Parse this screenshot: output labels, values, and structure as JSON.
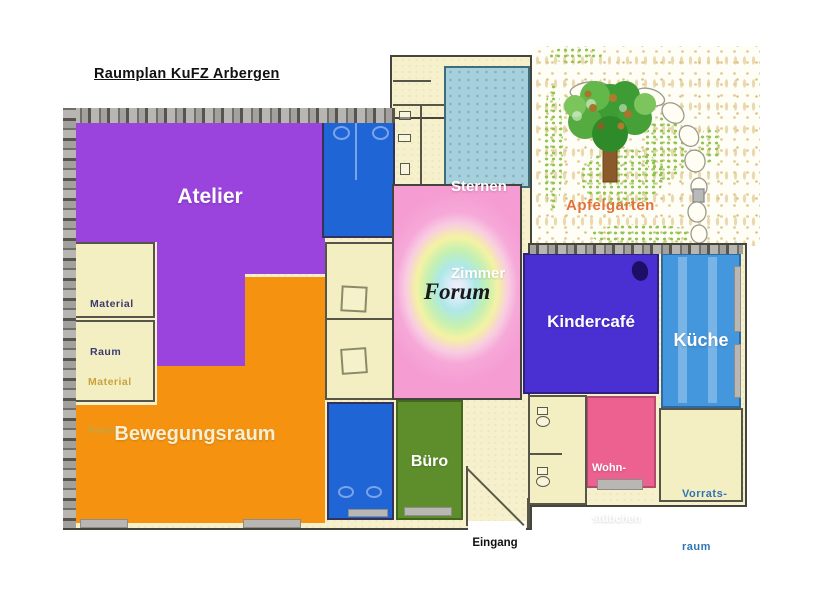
{
  "title": "Raumplan KuFZ Arbergen",
  "entrance": {
    "label": "Eingang"
  },
  "rooms": {
    "atelier": {
      "label": "Atelier"
    },
    "material_raum_1": {
      "line1": "Material",
      "line2": "Raum"
    },
    "material_raum_2": {
      "line1": "Material",
      "line2": "Raum"
    },
    "bewegungsraum": {
      "label": "Bewegungsraum"
    },
    "sternenzimmer": {
      "line1": "Sternen",
      "line2": "Zimmer"
    },
    "forum": {
      "label": "Forum"
    },
    "apfelgarten": {
      "label": "Apfelgarten"
    },
    "kindercafe": {
      "label": "Kindercafé"
    },
    "kueche": {
      "label": "Küche"
    },
    "buero": {
      "label": "Büro"
    },
    "wohnstuebchen": {
      "line1": "Wohn-",
      "line2": "stübchen"
    },
    "vorratsraum": {
      "line1": "Vorrats-",
      "line2": "raum"
    }
  },
  "colors": {
    "atelier": "#9a43dd",
    "bewegungsraum": "#f59311",
    "kindercafe": "#4a2fd2",
    "kueche": "#4497dc",
    "buero": "#5e8e2c",
    "wohnstuebchen": "#ed6190",
    "bathroom_blue": "#1f65d6",
    "sternenzimmer": "#a7cfdc",
    "cream_room": "#f4efc2",
    "wall_grey": "#b3b1b1",
    "title_text": "#111111",
    "apfelgarten_text": "#e2713c",
    "vorrats_text": "#2f74b5",
    "material1_text": "#3b3b6e",
    "material2_text": "#c9a23e"
  }
}
